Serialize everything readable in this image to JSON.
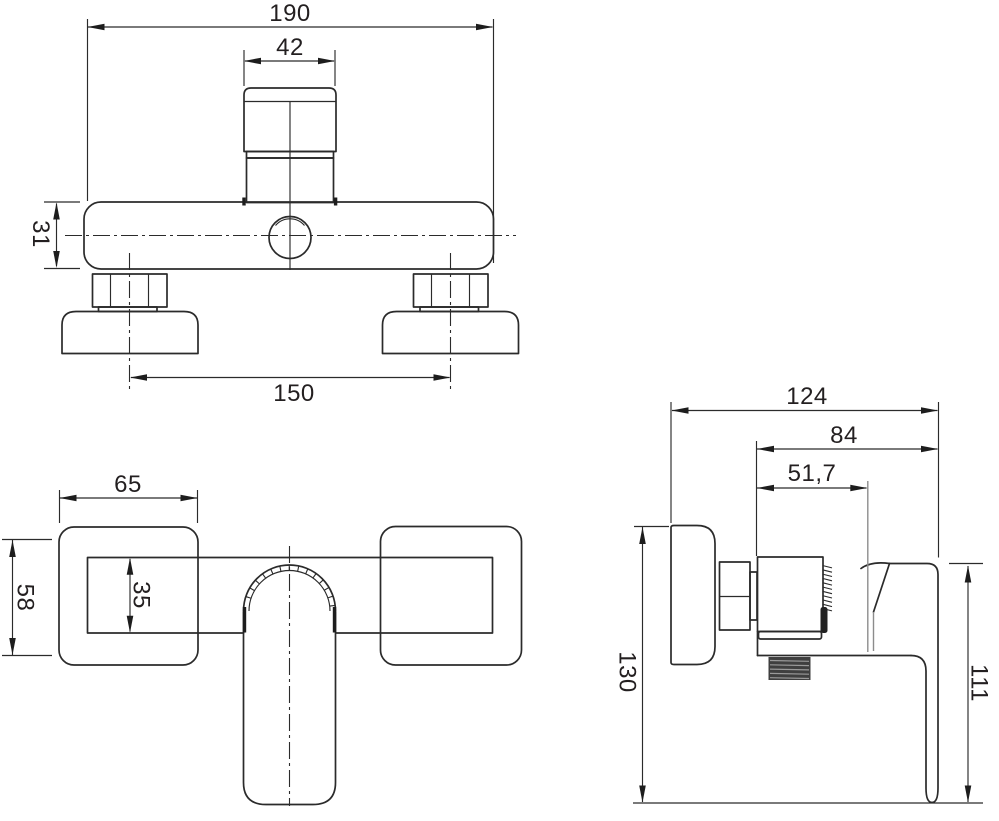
{
  "sheet": {
    "background": "#ffffff",
    "line_color": "#2b2b2b",
    "text_color": "#231f20"
  },
  "views": {
    "front": {
      "dims": {
        "overall_width": "190",
        "cartridge_width": "42",
        "body_height": "31",
        "connection_spacing": "150"
      }
    },
    "top": {
      "dims": {
        "flange_width": "65",
        "flange_depth": "58",
        "body_depth": "35"
      }
    },
    "side": {
      "dims": {
        "overall_depth": "124",
        "handle_depth": "84",
        "body_depth": "51,7",
        "overall_height": "130",
        "handle_height": "111"
      }
    }
  }
}
